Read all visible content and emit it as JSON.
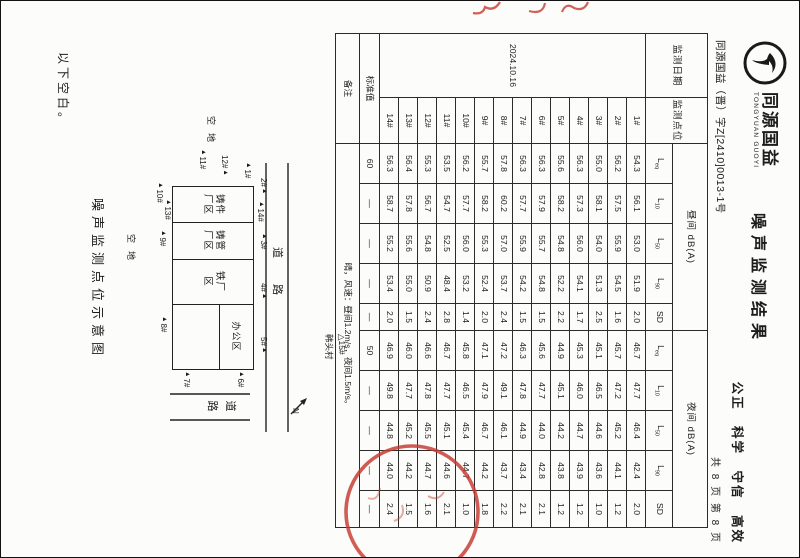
{
  "page": {
    "logo_cn": "同源国益",
    "logo_en": "TONGYUAN GUOYI",
    "doc_number": "同源国益（晋）字Z[2410]0013-1号",
    "slogan": "公正 科学 守信 高效",
    "page_info": "共 8 页  第 8 页",
    "title": "噪声监测结果",
    "closing_note": "以下空白。"
  },
  "table": {
    "date_header": "监测日期",
    "point_header": "监测点位",
    "day_group": "昼间 dB(A)",
    "night_group": "夜间 dB(A)",
    "sub_headers": [
      {
        "base": "L",
        "sub": "eq"
      },
      {
        "base": "L",
        "sub": "10"
      },
      {
        "base": "L",
        "sub": "50"
      },
      {
        "base": "L",
        "sub": "90"
      },
      {
        "base": "SD",
        "sub": ""
      }
    ],
    "date_value": "2024.10.16",
    "rows": [
      {
        "point": "1#",
        "day": [
          "54.3",
          "56.1",
          "53.0",
          "51.9",
          "2.0"
        ],
        "night": [
          "46.7",
          "47.7",
          "46.4",
          "42.4",
          "2.0"
        ]
      },
      {
        "point": "2#",
        "day": [
          "56.2",
          "57.5",
          "55.9",
          "54.5",
          "1.6"
        ],
        "night": [
          "45.7",
          "47.2",
          "45.2",
          "44.1",
          "1.2"
        ]
      },
      {
        "point": "3#",
        "day": [
          "55.0",
          "58.1",
          "54.0",
          "51.3",
          "2.5"
        ],
        "night": [
          "45.1",
          "46.5",
          "44.6",
          "43.6",
          "1.0"
        ]
      },
      {
        "point": "4#",
        "day": [
          "56.3",
          "57.3",
          "56.0",
          "54.1",
          "1.7"
        ],
        "night": [
          "45.3",
          "46.0",
          "44.7",
          "43.9",
          "1.2"
        ]
      },
      {
        "point": "5#",
        "day": [
          "55.6",
          "58.2",
          "54.8",
          "52.2",
          "2.2"
        ],
        "night": [
          "44.9",
          "45.1",
          "44.2",
          "43.8",
          "1.2"
        ]
      },
      {
        "point": "6#",
        "day": [
          "56.3",
          "57.9",
          "55.7",
          "54.8",
          "1.5"
        ],
        "night": [
          "45.6",
          "47.7",
          "44.0",
          "42.8",
          "2.1"
        ]
      },
      {
        "point": "7#",
        "day": [
          "56.3",
          "57.7",
          "55.9",
          "54.2",
          "1.5"
        ],
        "night": [
          "46.3",
          "47.8",
          "44.9",
          "43.4",
          "2.1"
        ]
      },
      {
        "point": "8#",
        "day": [
          "57.8",
          "60.2",
          "57.0",
          "53.7",
          "2.4"
        ],
        "night": [
          "47.2",
          "49.1",
          "46.1",
          "43.7",
          "2.2"
        ]
      },
      {
        "point": "9#",
        "day": [
          "55.7",
          "58.2",
          "55.3",
          "52.4",
          "2.0"
        ],
        "night": [
          "47.1",
          "47.9",
          "46.7",
          "44.2",
          "1.8"
        ]
      },
      {
        "point": "10#",
        "day": [
          "56.2",
          "57.7",
          "56.0",
          "53.2",
          "1.4"
        ],
        "night": [
          "45.8",
          "46.5",
          "45.4",
          "44.7",
          "1.0"
        ]
      },
      {
        "point": "11#",
        "day": [
          "53.5",
          "54.7",
          "52.5",
          "48.4",
          "2.8"
        ],
        "night": [
          "46.7",
          "47.7",
          "45.1",
          "44.6",
          "2.1"
        ]
      },
      {
        "point": "12#",
        "day": [
          "55.3",
          "56.7",
          "54.8",
          "50.9",
          "2.4"
        ],
        "night": [
          "46.6",
          "47.8",
          "45.5",
          "44.7",
          "1.6"
        ]
      },
      {
        "point": "13#",
        "day": [
          "56.4",
          "57.8",
          "55.6",
          "55.0",
          "1.5"
        ],
        "night": [
          "46.0",
          "47.7",
          "45.2",
          "44.2",
          "1.5"
        ]
      },
      {
        "point": "14#",
        "day": [
          "56.3",
          "58.7",
          "55.2",
          "53.4",
          "2.0"
        ],
        "night": [
          "46.9",
          "49.8",
          "44.8",
          "44.0",
          "2.4"
        ]
      }
    ],
    "standard": {
      "label": "标准值",
      "day": [
        "60",
        "—",
        "—",
        "—",
        "—"
      ],
      "night": [
        "50",
        "—",
        "—",
        "—",
        "—"
      ]
    },
    "remark": {
      "label": "备注",
      "text": "晴，风速：昼间1.2m/s，夜间1.5m/s。"
    }
  },
  "diagram": {
    "title": "噪声监测点位示意图",
    "blocks": [
      {
        "line1": "铸件",
        "line2": "厂区"
      },
      {
        "line1": "铸管",
        "line2": "厂区"
      },
      {
        "line1": "铁厂",
        "line2": "区"
      }
    ],
    "office_label": "办公区",
    "road_label_h": "道路",
    "road_label_v": "道路",
    "open_land_left": "空地",
    "open_land_bottom": "空地",
    "village_marker": "△15#",
    "village_name": "韩头村",
    "north_label": "N",
    "markers": [
      {
        "label": "1#",
        "x": 162,
        "y": 548,
        "triFirst": true
      },
      {
        "label": "12#",
        "x": 155,
        "y": 571,
        "triFirst": false
      },
      {
        "label": "11#",
        "x": 149,
        "y": 593,
        "triFirst": true
      },
      {
        "label": "2#",
        "x": 178,
        "y": 532,
        "triFirst": false
      },
      {
        "label": "14#",
        "x": 201,
        "y": 535,
        "triFirst": true
      },
      {
        "label": "3#",
        "x": 233,
        "y": 532,
        "triFirst": true
      },
      {
        "label": "4#",
        "x": 283,
        "y": 532,
        "triFirst": false
      },
      {
        "label": "5#",
        "x": 337,
        "y": 532,
        "triFirst": false
      },
      {
        "label": "6#",
        "x": 371,
        "y": 555,
        "triFirst": true
      },
      {
        "label": "7#",
        "x": 371,
        "y": 609,
        "triFirst": true
      },
      {
        "label": "8#",
        "x": 316,
        "y": 632,
        "triFirst": true
      },
      {
        "label": "9#",
        "x": 230,
        "y": 633,
        "triFirst": true
      },
      {
        "label": "13#",
        "x": 199,
        "y": 628,
        "triFirst": true
      },
      {
        "label": "10#",
        "x": 182,
        "y": 636,
        "triFirst": true
      }
    ]
  },
  "stamp": {
    "seal_color": "#c63a30"
  }
}
